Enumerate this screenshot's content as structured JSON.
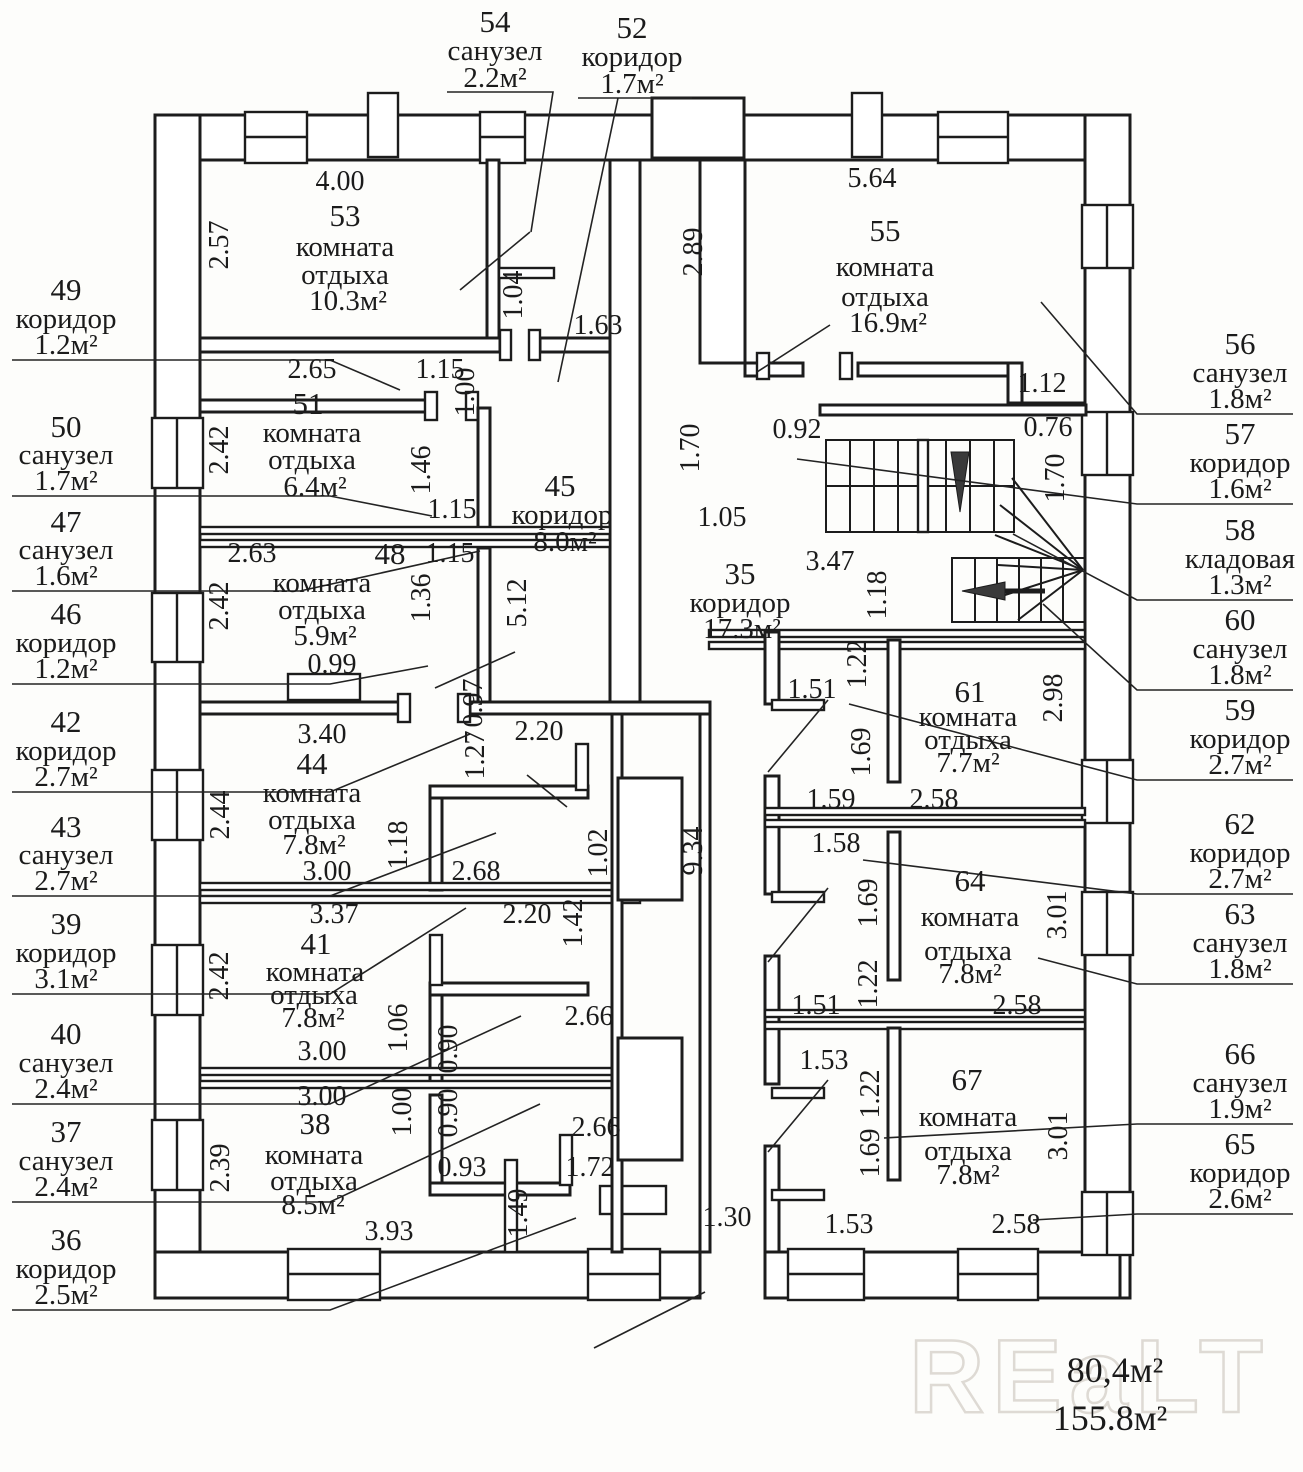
{
  "callouts": {
    "top": [
      {
        "num": "54",
        "name": "санузел",
        "area": "2.2м²"
      },
      {
        "num": "52",
        "name": "коридор",
        "area": "1.7м²"
      }
    ],
    "left": [
      {
        "num": "49",
        "name": "коридор",
        "area": "1.2м²"
      },
      {
        "num": "50",
        "name": "санузел",
        "area": "1.7м²"
      },
      {
        "num": "47",
        "name": "санузел",
        "area": "1.6м²"
      },
      {
        "num": "46",
        "name": "коридор",
        "area": "1.2м²"
      },
      {
        "num": "42",
        "name": "коридор",
        "area": "2.7м²"
      },
      {
        "num": "43",
        "name": "санузел",
        "area": "2.7м²"
      },
      {
        "num": "39",
        "name": "коридор",
        "area": "3.1м²"
      },
      {
        "num": "40",
        "name": "санузел",
        "area": "2.4м²"
      },
      {
        "num": "37",
        "name": "санузел",
        "area": "2.4м²"
      },
      {
        "num": "36",
        "name": "коридор",
        "area": "2.5м²"
      }
    ],
    "right": [
      {
        "num": "56",
        "name": "санузел",
        "area": "1.8м²"
      },
      {
        "num": "57",
        "name": "коридор",
        "area": "1.6м²"
      },
      {
        "num": "58",
        "name": "кладовая",
        "area": "1.3м²"
      },
      {
        "num": "60",
        "name": "санузел",
        "area": "1.8м²"
      },
      {
        "num": "59",
        "name": "коридор",
        "area": "2.7м²"
      },
      {
        "num": "62",
        "name": "коридор",
        "area": "2.7м²"
      },
      {
        "num": "63",
        "name": "санузел",
        "area": "1.8м²"
      },
      {
        "num": "66",
        "name": "санузел",
        "area": "1.9м²"
      },
      {
        "num": "65",
        "name": "коридор",
        "area": "2.6м²"
      }
    ]
  },
  "rooms": {
    "r53": {
      "num": "53",
      "line1": "комната",
      "line2": "отдыха",
      "area": "10.3м²"
    },
    "r55": {
      "num": "55",
      "line1": "комната",
      "line2": "отдыха",
      "area": "16.9м²"
    },
    "r51": {
      "num": "51",
      "line1": "комната",
      "line2": "отдыха",
      "area": "6.4м²"
    },
    "r48": {
      "num": "48",
      "line1": "комната",
      "line2": "отдыха",
      "area": "5.9м²"
    },
    "r45": {
      "num": "45",
      "line1": "коридор",
      "area": "8.0м²"
    },
    "r35": {
      "num": "35",
      "line1": "коридор",
      "area": "17.3м²"
    },
    "r44": {
      "num": "44",
      "line1": "комната",
      "line2": "отдыха",
      "area": "7.8м²"
    },
    "r41": {
      "num": "41",
      "line1": "комната",
      "line2": "отдыха",
      "area": "7.8м²"
    },
    "r38": {
      "num": "38",
      "line1": "комната",
      "line2": "отдыха",
      "area": "8.5м²"
    },
    "r61": {
      "num": "61",
      "line1": "комната",
      "line2": "отдыха",
      "area": "7.7м²"
    },
    "r64": {
      "num": "64",
      "line1": "комната",
      "line2": "отдыха",
      "area": "7.8м²"
    },
    "r67": {
      "num": "67",
      "line1": "комната",
      "line2": "отдыха",
      "area": "7.8м²"
    }
  },
  "dims": {
    "d400": "4.00",
    "d257": "2.57",
    "d265": "2.65",
    "d115a": "1.15",
    "d100a": "1.00",
    "d104": "1.04",
    "d163": "1.63",
    "d564": "5.64",
    "d289": "2.89",
    "d112": "1.12",
    "d092": "0.92",
    "d076": "0.76",
    "d170a": "1.70",
    "d170b": "1.70",
    "d105": "1.05",
    "d347": "3.47",
    "d118a": "1.18",
    "d242a": "2.42",
    "d146": "1.46",
    "d115b": "1.15",
    "d115c": "1.15",
    "d263": "2.63",
    "d242b": "2.42",
    "d136": "1.36",
    "d099": "0.99",
    "d097": "0.97",
    "d512": "5.12",
    "d340": "3.40",
    "d244": "2.44",
    "d127": "1.27",
    "d220a": "2.20",
    "d118b": "1.18",
    "d268": "2.68",
    "d300a": "3.00",
    "d102": "1.02",
    "d934": "9.34",
    "d142": "1.42",
    "d220b": "2.20",
    "d337": "3.37",
    "d242c": "2.42",
    "d106": "1.06",
    "d090a": "0.90",
    "d266a": "2.66",
    "d300b": "3.00",
    "d300c": "3.00",
    "d100b": "1.00",
    "d090b": "0.90",
    "d093": "0.93",
    "d266b": "2.66",
    "d172": "1.72",
    "d149": "1.49",
    "d239": "2.39",
    "d393": "3.93",
    "d130": "1.30",
    "d151a": "1.51",
    "d122a": "1.22",
    "d169a": "1.69",
    "d159": "1.59",
    "d258a": "2.58",
    "d298": "2.98",
    "d158": "1.58",
    "d169b": "1.69",
    "d301a": "3.01",
    "d122b": "1.22",
    "d151b": "1.51",
    "d258b": "2.58",
    "d153a": "1.53",
    "d122c": "1.22",
    "d169c": "1.69",
    "d301b": "3.01",
    "d153b": "1.53",
    "d258c": "2.58"
  },
  "totals": {
    "upper": "80,4м²",
    "lower": "155.8м²"
  },
  "watermark": "REaLT"
}
